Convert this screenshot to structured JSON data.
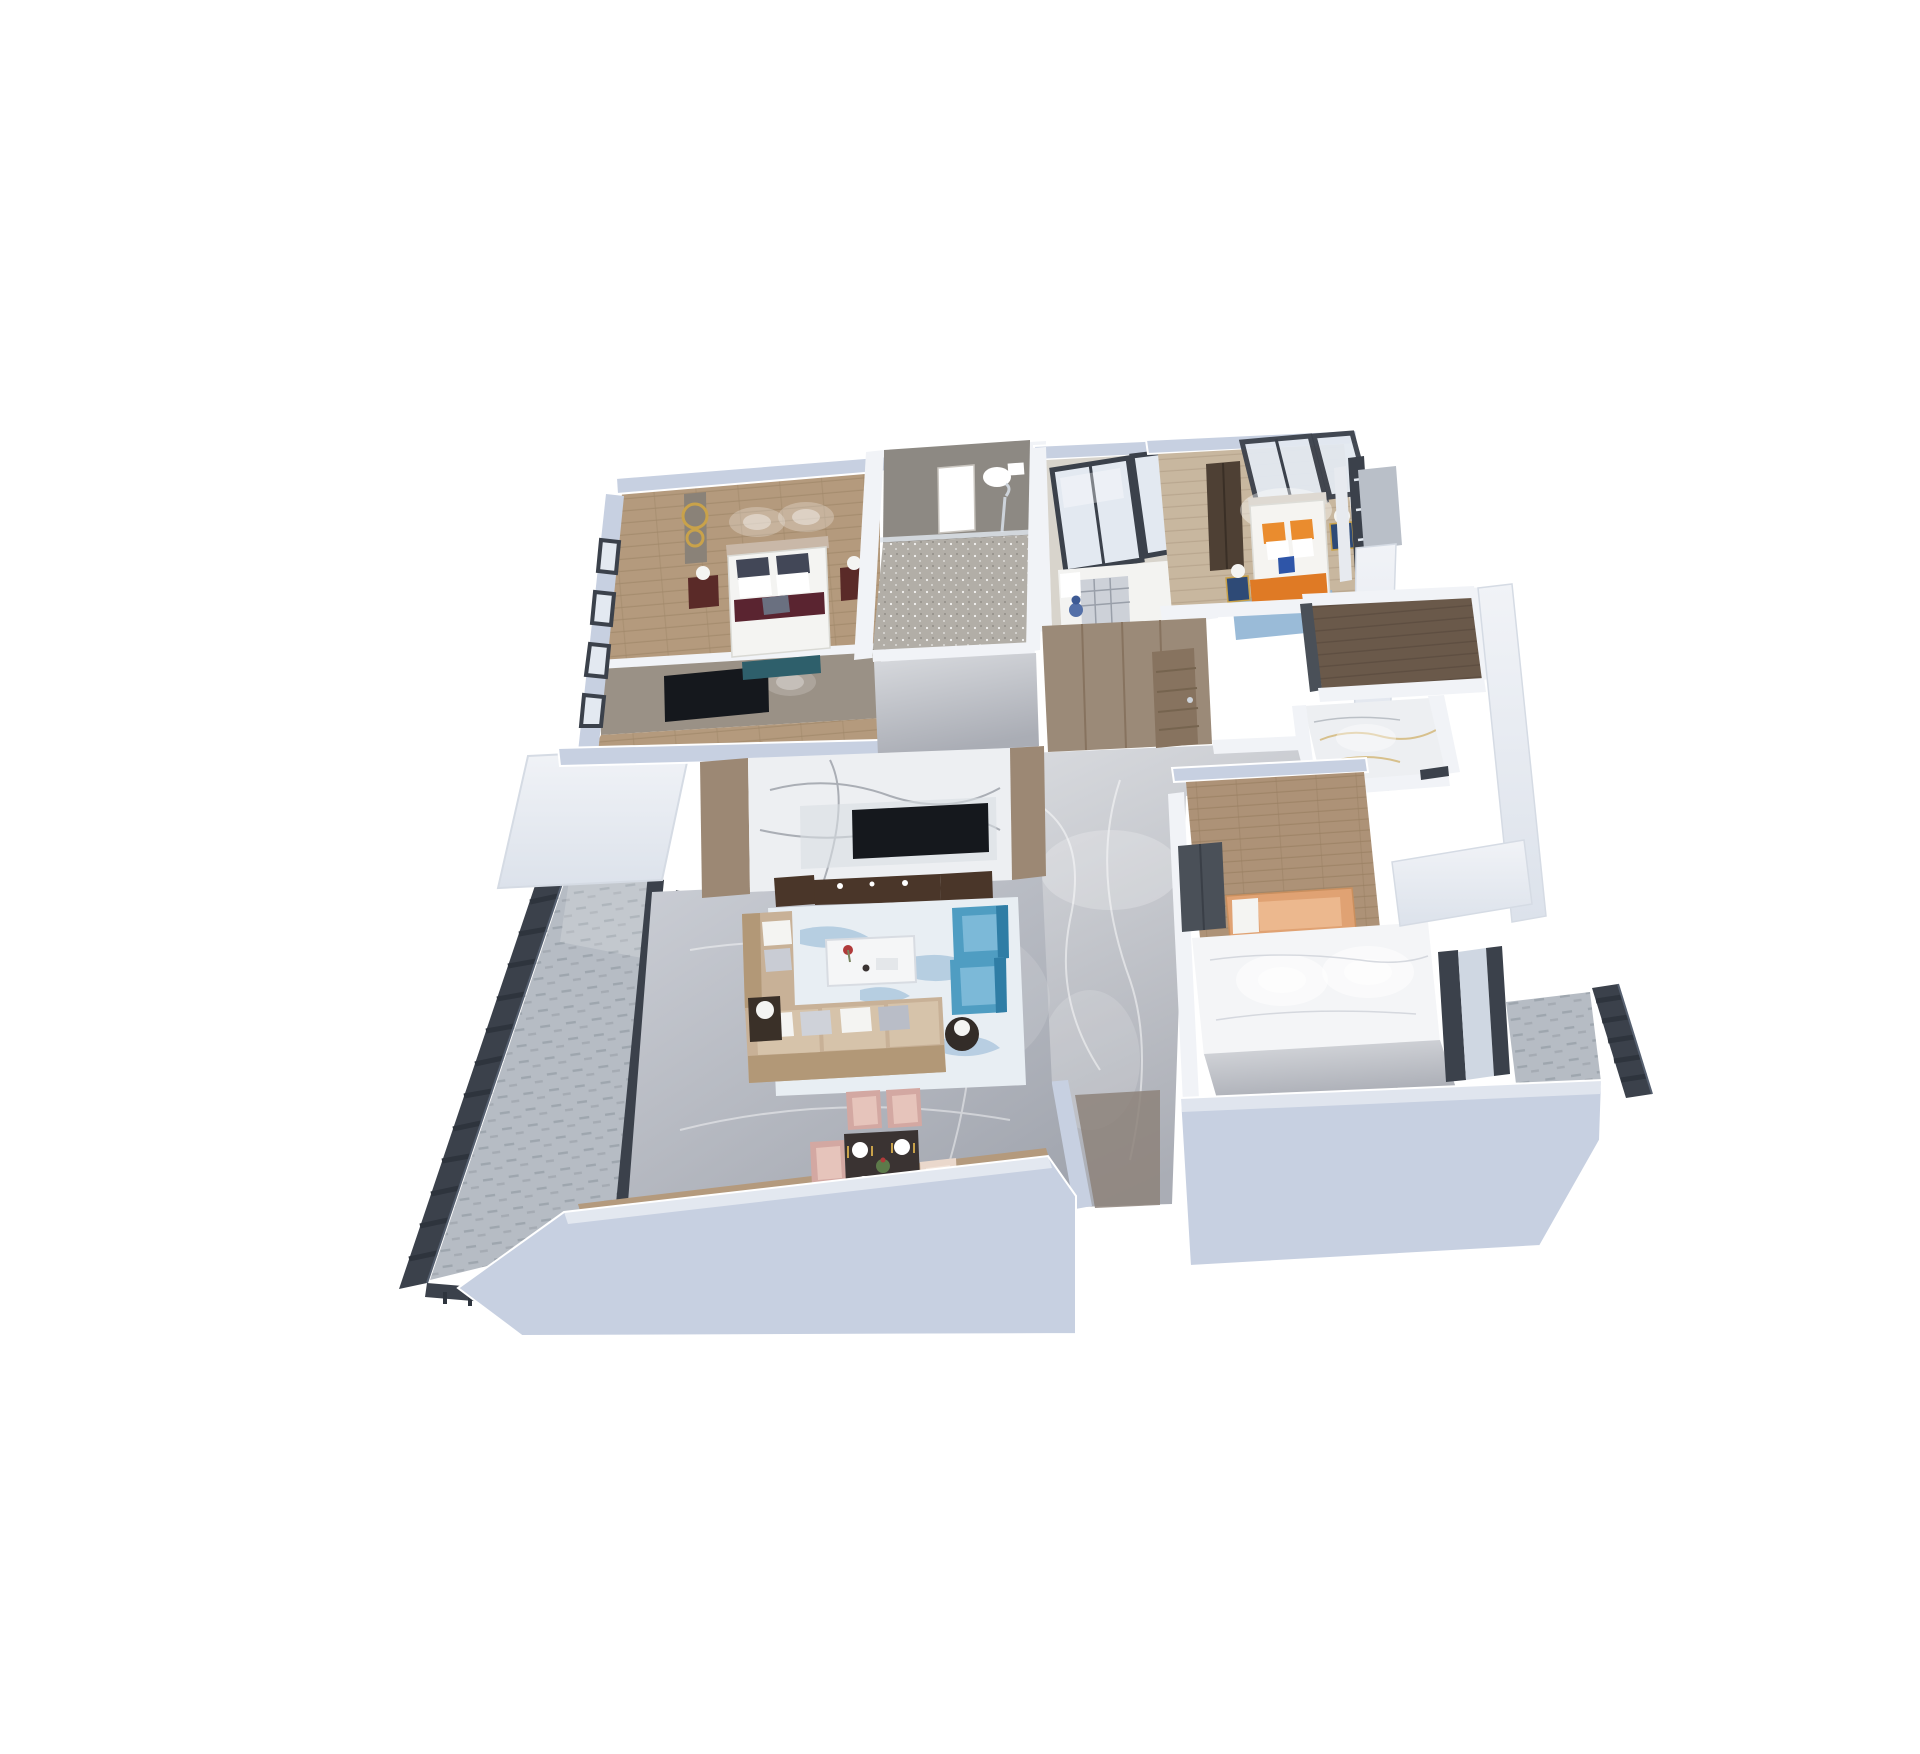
{
  "scene": {
    "type": "isometric-3d-floor-plan-render",
    "view": "top-down dollhouse cutaway",
    "background": "#ffffff",
    "text_visible": "none"
  },
  "colors": {
    "bg": "#ffffff",
    "wallTop": "#c7d0e1",
    "wallTopDeep": "#aeb9cd",
    "wallFace": "#f1f3f7",
    "wallFaceShade": "#dce2eb",
    "charcoal": "#3b414b",
    "charcoalDeep": "#2e343d",
    "glass": "#e3e9f1",
    "glassDim": "#cfd7e2",
    "floorA": "#cbced5",
    "floorB": "#a2a6af",
    "hallA": "#d9dbdf",
    "hallB": "#aaadb5",
    "wood": "#b49a7d",
    "woodWarm": "#c8b79f",
    "plank": "#6a594a",
    "bathWall": "#8d8983",
    "bathFloor": "#b2aea7",
    "marbleWhite": "#edeff2",
    "gold": "#c9a24a",
    "taupe": "#9c8874",
    "taupeDeep": "#8a7c6e",
    "cabinet": "#9b8a78",
    "cabinetDeep": "#87735f",
    "walnut": "#4a3629",
    "tvBlack": "#15181d",
    "sofa": "#c8b197",
    "sofaDeep": "#b29877",
    "sofaLight": "#d6c3aa",
    "pillow": "#f4f4f2",
    "pillowDark": "#424757",
    "accentRed": "#5a2430",
    "teal": "#2e5f6b",
    "blue": "#4f9dc2",
    "blueDeep": "#2f7da5",
    "blueLight": "#7cb9d8",
    "rug": "#e8eef3",
    "rugBlue": "#8fb4d4",
    "pink": "#d3a8a2",
    "pinkLight": "#e6c4bb",
    "cream": "#ead8cc",
    "dtable": "#3a3332",
    "plate": "#ffffff",
    "green": "#5d7a4a",
    "orange": "#ea8c2e",
    "orangeDeep": "#df7a25",
    "peach": "#e0a273",
    "peachLight": "#ecb88e",
    "navy": "#2e4a76",
    "navyBox": "#2e55a8",
    "redwood": "#5a2a28",
    "railTile": "#b6bcc4",
    "railTileLine": "#99a0a9",
    "blanket": "#cdd1d8",
    "dollBlue": "#5470a8",
    "chrome": "#cdd3da"
  },
  "rooms": [
    {
      "id": "master-bedroom",
      "floor": "wood",
      "items": [
        "double-bed",
        "white-duvet",
        "dark-pillows",
        "red-accent-runner",
        "red-wood-nightstands",
        "table-lamps",
        "gold-ring-sculpture",
        "teal-foot-bench",
        "wall-tv",
        "ceiling-spotlights",
        "black-frame-windows"
      ]
    },
    {
      "id": "master-bathroom",
      "floor": "sparkle-gray-marble",
      "items": [
        "vanity-sink",
        "toilet",
        "shower-fixture",
        "glass-partition"
      ]
    },
    {
      "id": "small-bedroom",
      "floor": "light-gray",
      "items": [
        "single-bed",
        "plaid-blanket",
        "blue-doll",
        "black-frame-glazed-wall"
      ]
    },
    {
      "id": "bedroom-orange",
      "floor": "light-wood",
      "items": [
        "double-bed",
        "orange-pillows",
        "orange-throw",
        "blue-rug",
        "navy-gold-nightstands",
        "table-lamps",
        "dark-wardrobe",
        "curtain",
        "black-frame-window",
        "glazed-panels"
      ]
    },
    {
      "id": "walk-in-closet",
      "floor": "dark-wood-plank",
      "items": []
    },
    {
      "id": "bathroom-2",
      "floor": "white-gold-marble",
      "items": [
        "spotlights"
      ]
    },
    {
      "id": "entry-hall",
      "floor": "gray-marble",
      "items": [
        "wood-wardrobe-cabinets",
        "open-entry-door"
      ]
    },
    {
      "id": "living-room",
      "floor": "gray-marble",
      "items": [
        "white-marble-tv-wall",
        "flat-tv",
        "walnut-media-console",
        "display-cabinets",
        "beige-sectional-sofa",
        "white-coffee-table",
        "red-flowers",
        "blue-wing-armchairs",
        "blue-brush-area-rug",
        "side-tables",
        "table-lamps"
      ]
    },
    {
      "id": "dining-area",
      "floor": "gray-marble-wood-border",
      "items": [
        "dark-dining-table",
        "white-place-settings",
        "gold-cutlery",
        "plant-centerpiece",
        "pink-chairs",
        "cream-chair"
      ]
    },
    {
      "id": "bedroom-peach",
      "floor": "wood",
      "items": [
        "peach-bed",
        "white-pillows",
        "charcoal-wardrobe",
        "bright-marble-wall"
      ]
    },
    {
      "id": "study-nook",
      "floor": "gray-marble",
      "items": [
        "black-frame-windows",
        "charcoal-baseboard"
      ]
    },
    {
      "id": "balcony-left",
      "floor": "patterned-gray-tile",
      "items": [
        "dark-metal-railing",
        "sliding-door-frames"
      ]
    },
    {
      "id": "balcony-right",
      "floor": "patterned-gray-tile",
      "items": [
        "dark-metal-railing"
      ]
    }
  ]
}
